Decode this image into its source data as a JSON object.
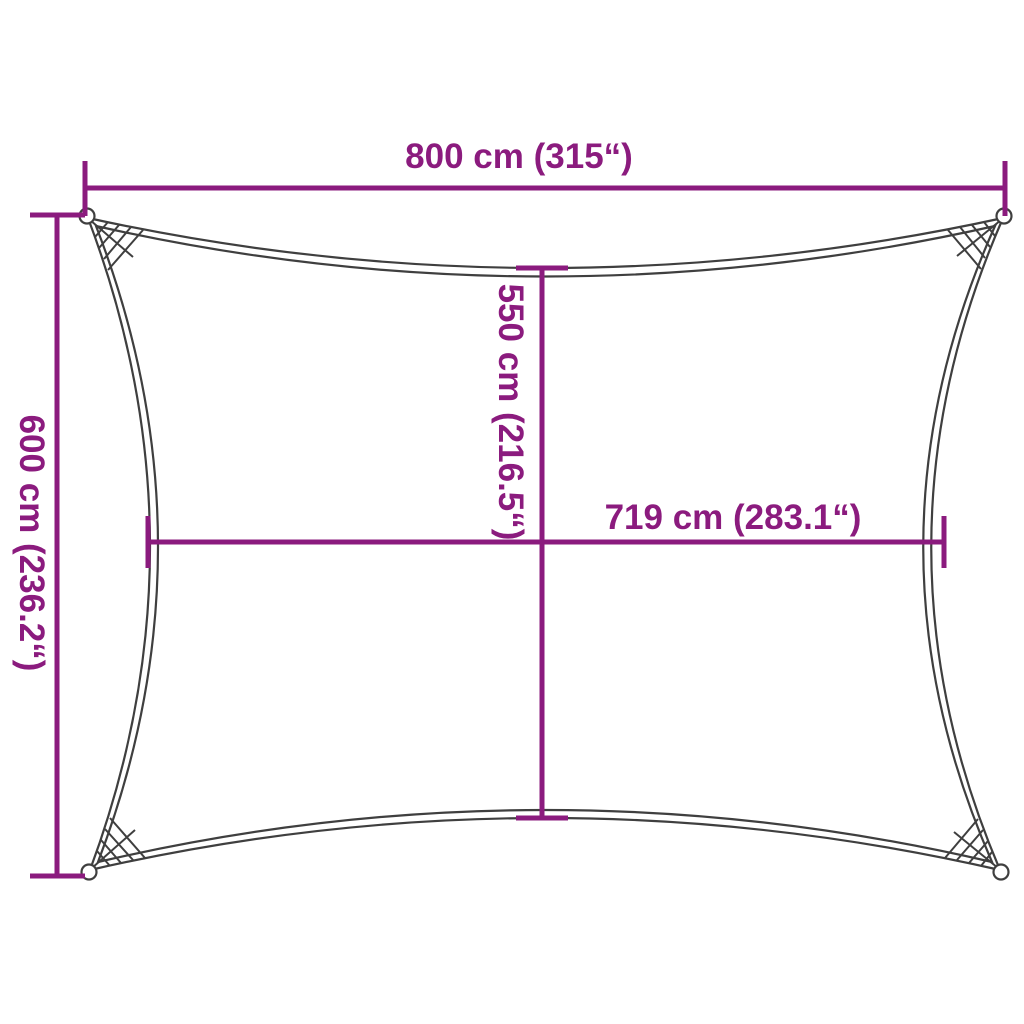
{
  "diagram": {
    "type": "shade-sail-dimension-diagram",
    "colors": {
      "dimension": "#8b1b7e",
      "outline": "#3f3f3f",
      "background": "#ffffff"
    },
    "dimensions": {
      "top_width": {
        "label": "800 cm (315“)",
        "cm": 800,
        "inches": 315
      },
      "left_height": {
        "label": "600 cm (236.2“)",
        "cm": 600,
        "inches": 236.2
      },
      "center_height": {
        "label": "550 cm (216.5“)",
        "cm": 550,
        "inches": 216.5
      },
      "center_width": {
        "label": "719 cm (283.1“)",
        "cm": 719,
        "inches": 283.1
      }
    }
  }
}
